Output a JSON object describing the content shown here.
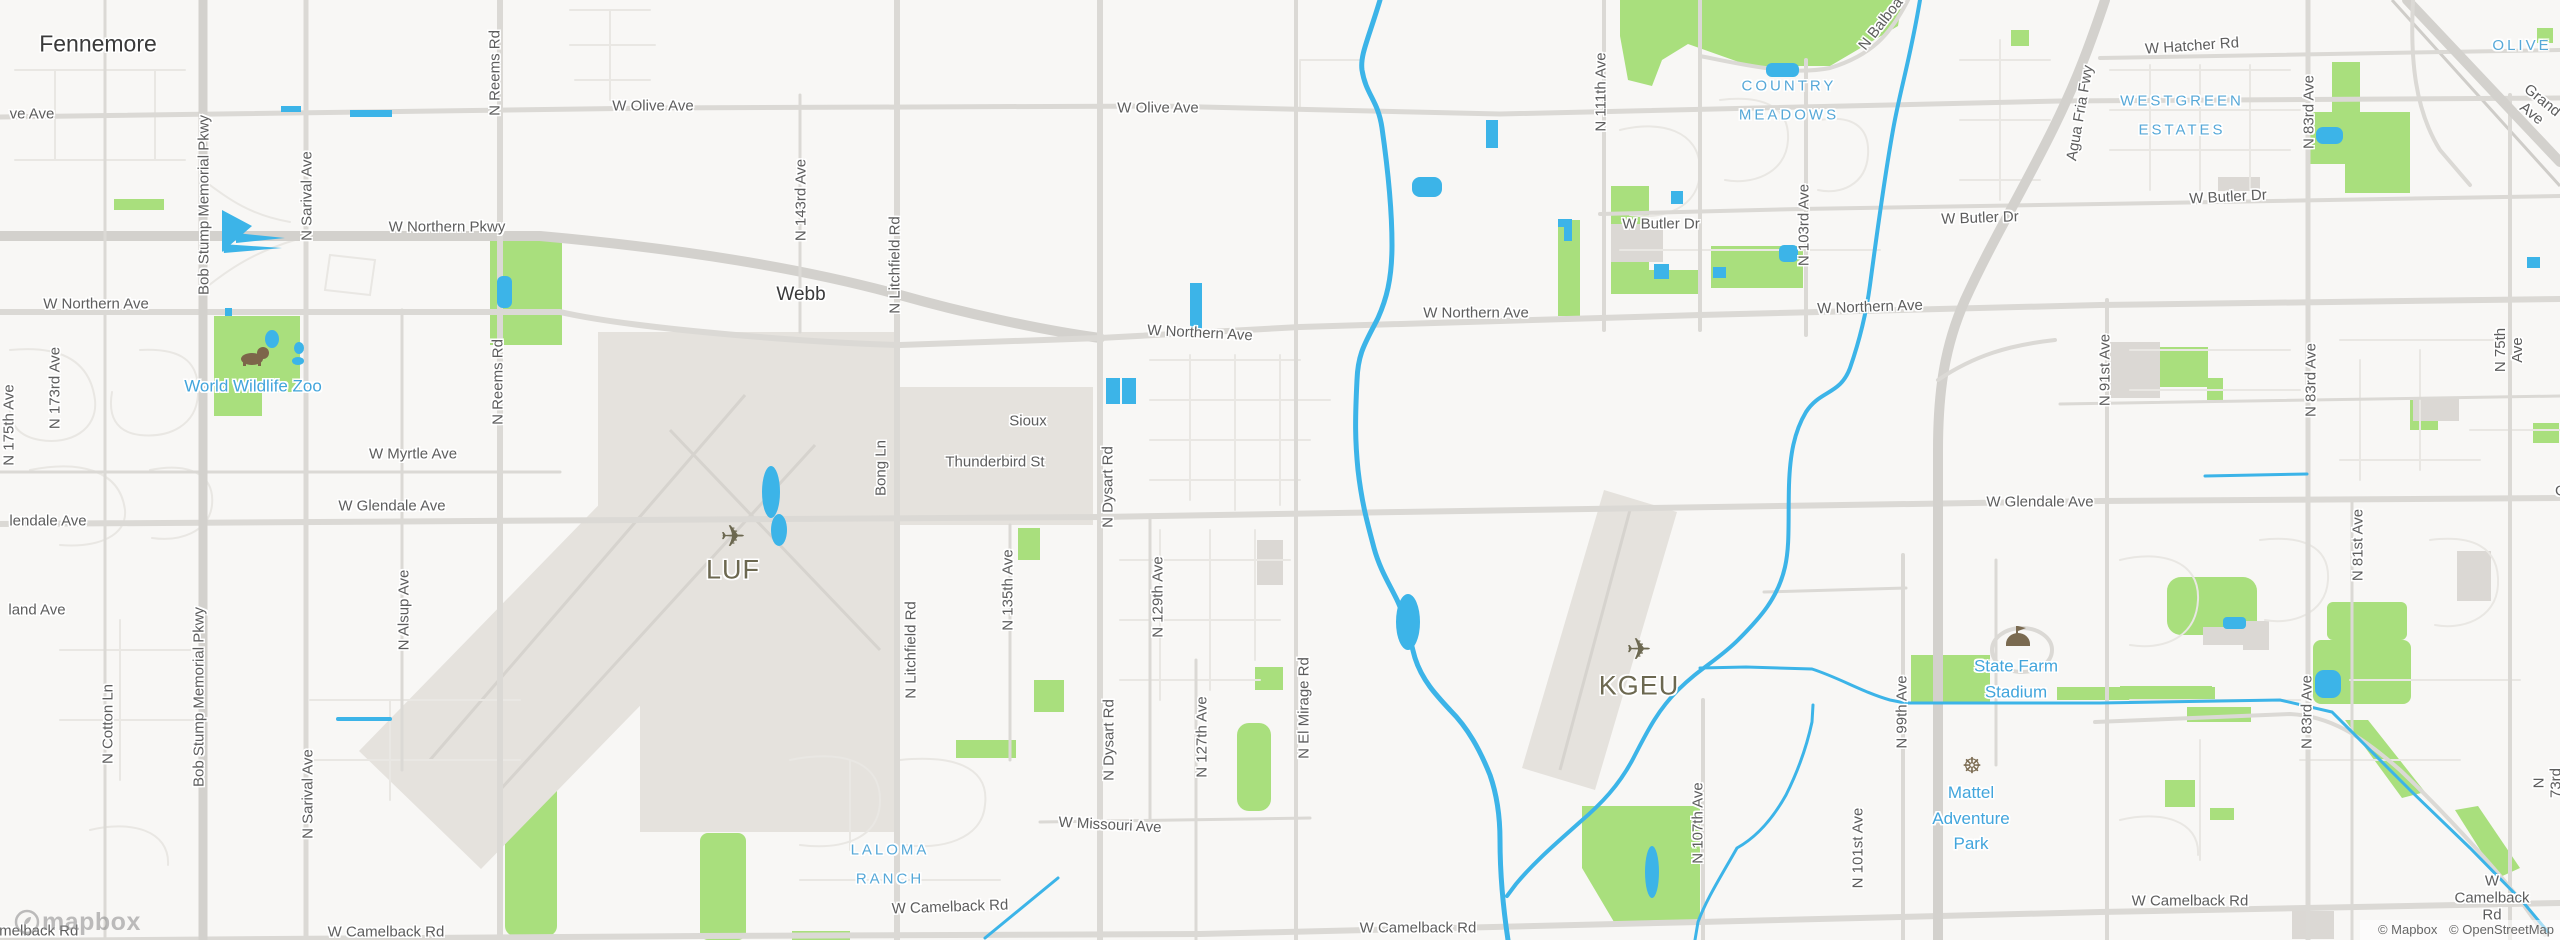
{
  "colors": {
    "bg": "#F8F7F5",
    "water": "#3CB4E8",
    "park": "#A9DF7D",
    "airport": "#E5E2DD",
    "building": "#DBD8D4",
    "road_major": "#D3D1CD",
    "road": "#DBD9D5",
    "road_minor": "#E9E7E3",
    "label_street": "#5D5D5D",
    "label_poi": "#42A5DC",
    "label_neighborhood": "#56A8D8",
    "label_airport": "#6C6850"
  },
  "attribution": {
    "items": [
      "© Mapbox",
      "© OpenStreetMap"
    ]
  },
  "logo": {
    "text": "mapbox"
  },
  "labels": [
    {
      "t": "Fennemore",
      "x": 98,
      "y": 44,
      "c": "city"
    },
    {
      "t": "Webb",
      "x": 801,
      "y": 295,
      "c": "town"
    },
    {
      "t": "ve Ave",
      "x": 32,
      "y": 114,
      "c": "st"
    },
    {
      "t": "W Olive Ave",
      "x": 653,
      "y": 106,
      "c": "st"
    },
    {
      "t": "W Olive Ave",
      "x": 1158,
      "y": 108,
      "c": "st"
    },
    {
      "t": "W Northern Pkwy",
      "x": 447,
      "y": 227,
      "c": "st"
    },
    {
      "t": "W Northern Ave",
      "x": 96,
      "y": 304,
      "c": "st"
    },
    {
      "t": "W Northern Ave",
      "x": 1200,
      "y": 333,
      "c": "st",
      "r": 3
    },
    {
      "t": "W Northern Ave",
      "x": 1476,
      "y": 313,
      "c": "st"
    },
    {
      "t": "W Northern Ave",
      "x": 1870,
      "y": 307,
      "c": "st",
      "r": -2
    },
    {
      "t": "W Butler Dr",
      "x": 1661,
      "y": 224,
      "c": "st"
    },
    {
      "t": "W Butler Dr",
      "x": 1980,
      "y": 218,
      "c": "st",
      "r": -2
    },
    {
      "t": "W Butler Dr",
      "x": 2228,
      "y": 197,
      "c": "st",
      "r": -3
    },
    {
      "t": "W Hatcher Rd",
      "x": 2192,
      "y": 46,
      "c": "st",
      "r": -4
    },
    {
      "t": "W Myrtle Ave",
      "x": 413,
      "y": 454,
      "c": "st"
    },
    {
      "t": "lendale Ave",
      "x": 48,
      "y": 521,
      "c": "st"
    },
    {
      "t": "W Glendale Ave",
      "x": 392,
      "y": 506,
      "c": "st"
    },
    {
      "t": "W Glendale Ave",
      "x": 2040,
      "y": 502,
      "c": "st"
    },
    {
      "t": "W Glendale Ave",
      "x": 2585,
      "y": 491,
      "c": "st"
    },
    {
      "t": "land Ave",
      "x": 37,
      "y": 610,
      "c": "st"
    },
    {
      "t": "Sioux",
      "x": 1028,
      "y": 421,
      "c": "st"
    },
    {
      "t": "Thunderbird St",
      "x": 995,
      "y": 462,
      "c": "st"
    },
    {
      "t": "W Missouri Ave",
      "x": 1110,
      "y": 825,
      "c": "st",
      "r": 3
    },
    {
      "t": "W Camelback Rd",
      "x": 20,
      "y": 931,
      "c": "st"
    },
    {
      "t": "W Camelback Rd",
      "x": 386,
      "y": 932,
      "c": "st"
    },
    {
      "t": "W Camelback Rd",
      "x": 950,
      "y": 907,
      "c": "st",
      "r": -2
    },
    {
      "t": "W Camelback Rd",
      "x": 1418,
      "y": 928,
      "c": "st"
    },
    {
      "t": "W Camelback Rd",
      "x": 2190,
      "y": 901,
      "c": "st"
    },
    {
      "t": "W Camelback Rd",
      "x": 2492,
      "y": 898,
      "c": "st"
    },
    {
      "t": "Bob Stump Memorial Pkwy",
      "x": 204,
      "y": 205,
      "c": "st",
      "r": -90
    },
    {
      "t": "Bob Stump Memorial Pkwy",
      "x": 199,
      "y": 697,
      "c": "st",
      "r": -90
    },
    {
      "t": "N Sarival Ave",
      "x": 307,
      "y": 196,
      "c": "st",
      "r": -90
    },
    {
      "t": "N Sarival Ave",
      "x": 308,
      "y": 794,
      "c": "st",
      "r": -90
    },
    {
      "t": "N Reems Rd",
      "x": 495,
      "y": 73,
      "c": "st",
      "r": -90
    },
    {
      "t": "N Reems Rd",
      "x": 498,
      "y": 382,
      "c": "st",
      "r": -90
    },
    {
      "t": "N 175th Ave",
      "x": 9,
      "y": 425,
      "c": "st",
      "r": -90
    },
    {
      "t": "N 173rd Ave",
      "x": 55,
      "y": 388,
      "c": "st",
      "r": -90
    },
    {
      "t": "N Cotton Ln",
      "x": 108,
      "y": 724,
      "c": "st",
      "r": -90
    },
    {
      "t": "N Alsup Ave",
      "x": 404,
      "y": 610,
      "c": "st",
      "r": -90
    },
    {
      "t": "N 143rd Ave",
      "x": 801,
      "y": 200,
      "c": "st",
      "r": -90
    },
    {
      "t": "N Litchfield Rd",
      "x": 895,
      "y": 265,
      "c": "st",
      "r": -90
    },
    {
      "t": "N Litchfield Rd",
      "x": 911,
      "y": 650,
      "c": "st",
      "r": -90
    },
    {
      "t": "Bong Ln",
      "x": 881,
      "y": 468,
      "c": "st",
      "r": -90
    },
    {
      "t": "N 135th Ave",
      "x": 1008,
      "y": 590,
      "c": "st",
      "r": -90
    },
    {
      "t": "N Dysart Rd",
      "x": 1108,
      "y": 487,
      "c": "st",
      "r": -90
    },
    {
      "t": "N Dysart Rd",
      "x": 1109,
      "y": 740,
      "c": "st",
      "r": -90
    },
    {
      "t": "N 129th Ave",
      "x": 1158,
      "y": 597,
      "c": "st",
      "r": -90
    },
    {
      "t": "N 127th Ave",
      "x": 1202,
      "y": 737,
      "c": "st",
      "r": -90
    },
    {
      "t": "N El Mirage Rd",
      "x": 1304,
      "y": 708,
      "c": "st",
      "r": -90
    },
    {
      "t": "N 111th Ave",
      "x": 1601,
      "y": 92,
      "c": "st",
      "r": -90
    },
    {
      "t": "N 103rd Ave",
      "x": 1804,
      "y": 225,
      "c": "st",
      "r": -90
    },
    {
      "t": "N 107th Ave",
      "x": 1698,
      "y": 823,
      "c": "st",
      "r": -90
    },
    {
      "t": "N 101st Ave",
      "x": 1858,
      "y": 848,
      "c": "st",
      "r": -90
    },
    {
      "t": "N 99th Ave",
      "x": 1902,
      "y": 712,
      "c": "st",
      "r": -90
    },
    {
      "t": "N 91st Ave",
      "x": 2105,
      "y": 370,
      "c": "st",
      "r": -90
    },
    {
      "t": "N 83rd Ave",
      "x": 2309,
      "y": 112,
      "c": "st",
      "r": -90
    },
    {
      "t": "N 83rd Ave",
      "x": 2311,
      "y": 380,
      "c": "st",
      "r": -90
    },
    {
      "t": "N 83rd Ave",
      "x": 2307,
      "y": 712,
      "c": "st",
      "r": -90
    },
    {
      "t": "N 81st Ave",
      "x": 2358,
      "y": 545,
      "c": "st",
      "r": -90
    },
    {
      "t": "N 75th Ave",
      "x": 2509,
      "y": 350,
      "c": "st",
      "r": -90
    },
    {
      "t": "N 73rd Ave",
      "x": 2556,
      "y": 783,
      "c": "st",
      "r": -90
    },
    {
      "t": "Agua Fria Fwy",
      "x": 2080,
      "y": 113,
      "c": "st",
      "r": -80
    },
    {
      "t": "N Balboa Dr",
      "x": 1887,
      "y": 16,
      "c": "st",
      "r": -52
    },
    {
      "t": "Grand Ave",
      "x": 2537,
      "y": 107,
      "c": "st",
      "r": 39
    },
    {
      "t": "COUNTRY\nMEADOWS",
      "x": 1789,
      "y": 101,
      "c": "nb"
    },
    {
      "t": "LALOMA\nRANCH",
      "x": 890,
      "y": 865,
      "c": "nb"
    },
    {
      "t": "WESTGREEN\nESTATES",
      "x": 2182,
      "y": 116,
      "c": "nb"
    },
    {
      "t": "OLIVE",
      "x": 2522,
      "y": 46,
      "c": "nb"
    },
    {
      "t": "World Wildlife Zoo",
      "x": 253,
      "y": 386,
      "c": "poi"
    },
    {
      "t": "State Farm\nStadium",
      "x": 2016,
      "y": 679,
      "c": "poi"
    },
    {
      "t": "Mattel\nAdventure\nPark",
      "x": 1971,
      "y": 818,
      "c": "poi"
    },
    {
      "t": "LUF",
      "x": 733,
      "y": 570,
      "c": "apt"
    },
    {
      "t": "KGEU",
      "x": 1639,
      "y": 686,
      "c": "apt"
    },
    {
      "t": "✈",
      "x": 733,
      "y": 537,
      "c": "picon"
    },
    {
      "t": "✈",
      "x": 1639,
      "y": 650,
      "c": "picon"
    },
    {
      "t": "☸",
      "x": 1972,
      "y": 766,
      "c": "wicon"
    }
  ]
}
